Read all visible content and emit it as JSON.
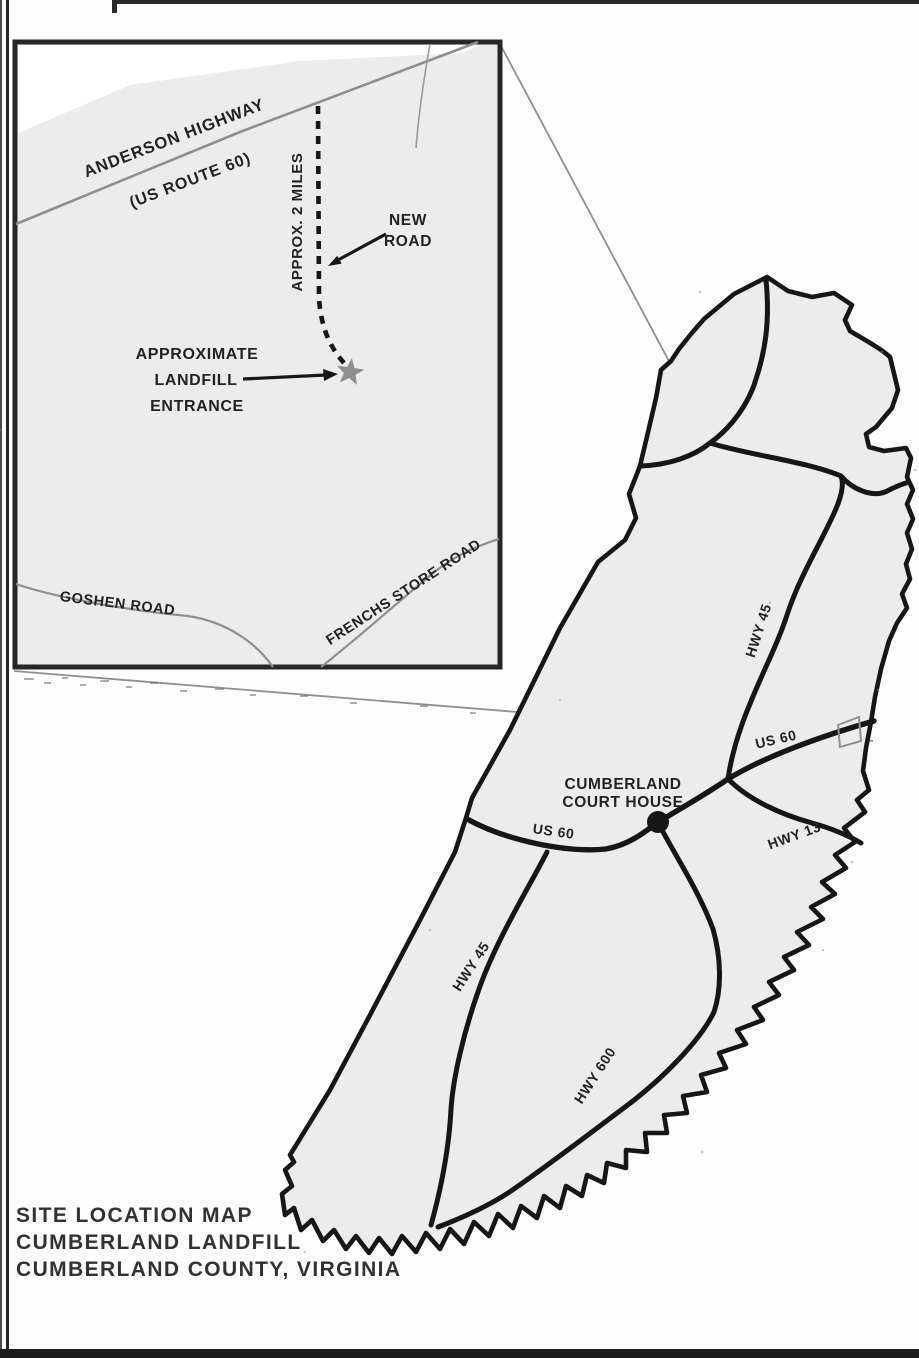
{
  "document": {
    "title_lines": [
      "SITE LOCATION MAP",
      "CUMBERLAND LANDFILL",
      "CUMBERLAND COUNTY, VIRGINIA"
    ]
  },
  "inset_map": {
    "highway_label": "ANDERSON HIGHWAY",
    "highway_route_label": "(US ROUTE 60)",
    "approx_distance_label": "APPROX. 2 MILES",
    "new_road_label": {
      "line1": "NEW",
      "line2": "ROAD"
    },
    "landfill_entrance_label": {
      "line1": "APPROXIMATE",
      "line2": "LANDFILL",
      "line3": "ENTRANCE"
    },
    "goshen_road_label": "GOSHEN ROAD",
    "frenchs_store_road_label": "FRENCHS STORE ROAD",
    "marker": "landfill-entrance-star"
  },
  "county_map": {
    "court_house_label": {
      "line1": "CUMBERLAND",
      "line2": "COURT HOUSE"
    },
    "hwy_45_north_label": "HWY 45",
    "hwy_45_south_label": "HWY 45",
    "us_60_west_label": "US 60",
    "us_60_east_label": "US 60",
    "hwy_13_label": "HWY 13",
    "hwy_600_label": "HWY 600"
  },
  "colors": {
    "map_fill": "#ececec",
    "road_black": "#141414",
    "minor_road_gray": "#8f8f8f",
    "leader_gray": "#909090",
    "border_dark": "#262626",
    "text_dark": "#222222",
    "star_gray": "#8e8e8e",
    "white_patch": "#ffffff"
  }
}
